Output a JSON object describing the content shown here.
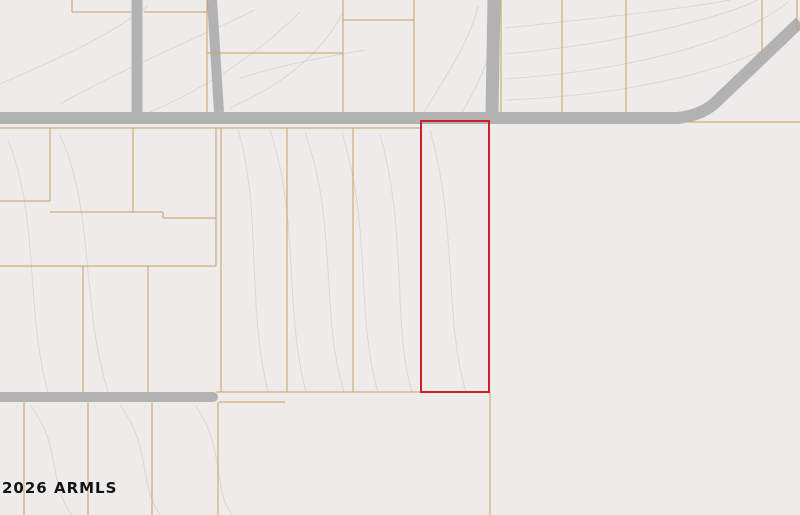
{
  "map": {
    "type": "county-plat-parcel-map",
    "copyright": "2026 ARMLS",
    "colors": {
      "background": "#edecea",
      "parcel_line": "#c7a061",
      "parcel_label": "#a0811f",
      "road": "#b2b2b2",
      "road_label": "#2f2f2f",
      "contour_line": "#d8d7d3",
      "contour_label": "#9b9b98",
      "highlight_outline": "#cb2026"
    },
    "highlight": {
      "apn": "211-21-013D",
      "outline_color": "#cb2026"
    },
    "road_labels": [
      {
        "text": "E Honda Bow Rd",
        "x": 345,
        "y": 117,
        "rot": 0
      },
      {
        "text": "E Honda Bow Rd",
        "x": 623,
        "y": 116,
        "rot": 0
      },
      {
        "text": "E Rolling Rock Dr",
        "x": 85,
        "y": 396,
        "rot": 0
      },
      {
        "text": "N 18Th Way",
        "x": 137,
        "y": 52,
        "rot": -90
      },
      {
        "text": "N 21St St",
        "x": 757,
        "y": 57,
        "rot": -40
      },
      {
        "text": "N",
        "x": 212,
        "y": 6,
        "rot": -90
      }
    ],
    "parcel_labels": [
      {
        "text": "202-20-654N",
        "x": 103,
        "y": 66
      },
      {
        "text": "202-20-654S",
        "x": 173,
        "y": 66
      },
      {
        "text": "202-20-654A",
        "x": 278,
        "y": 20
      },
      {
        "text": "202-20-654M",
        "x": 277,
        "y": 87
      },
      {
        "text": "202-20-654Q",
        "x": 380,
        "y": 70
      },
      {
        "text": "202-20-654P",
        "x": 446,
        "y": 62
      },
      {
        "text": "202-20-442D",
        "x": 531,
        "y": 53
      },
      {
        "text": "202-20-442B",
        "x": 595,
        "y": 54
      },
      {
        "text": "202-20-442F",
        "x": 687,
        "y": 46
      },
      {
        "text": "202-20-565",
        "x": 790,
        "y": 9
      },
      {
        "text": "211-21-009M",
        "x": 27,
        "y": 162
      },
      {
        "text": "211-21-009L",
        "x": 92,
        "y": 167
      },
      {
        "text": "211-21-009J",
        "x": 174,
        "y": 164
      },
      {
        "text": "211-21-009N",
        "x": 21,
        "y": 235
      },
      {
        "text": "211-21-009K",
        "x": 151,
        "y": 238
      },
      {
        "text": "211-21-009P",
        "x": 22,
        "y": 287
      },
      {
        "text": "211-21-009C",
        "x": 116,
        "y": 287
      },
      {
        "text": "211-21-009D",
        "x": 180,
        "y": 288
      },
      {
        "text": "211-21-009P",
        "x": 22,
        "y": 350
      },
      {
        "text": "211-21-009C",
        "x": 116,
        "y": 350
      },
      {
        "text": "211-21-009D",
        "x": 184,
        "y": 350
      },
      {
        "text": "211-21-013A",
        "x": 252,
        "y": 214
      },
      {
        "text": "211-21-013B",
        "x": 318,
        "y": 214
      },
      {
        "text": "211-21-013C",
        "x": 388,
        "y": 215
      },
      {
        "text": "211-21-013D",
        "x": 458,
        "y": 215
      },
      {
        "text": "211-21-013A",
        "x": 252,
        "y": 351
      },
      {
        "text": "211-21-013B",
        "x": 318,
        "y": 351
      },
      {
        "text": "211-21-013C",
        "x": 388,
        "y": 351
      },
      {
        "text": "211-21-013D",
        "x": 458,
        "y": 352
      },
      {
        "text": "211-21-030C",
        "x": -22,
        "y": 460
      },
      {
        "text": "211-21-030D",
        "x": 57,
        "y": 460
      },
      {
        "text": "211-21-010E",
        "x": 115,
        "y": 460
      },
      {
        "text": "211-21-010F",
        "x": 180,
        "y": 460
      },
      {
        "text": "211-21-005B",
        "x": 353,
        "y": 461
      }
    ],
    "contour_labels": [
      {
        "text": "2180",
        "x": 286,
        "y": 61,
        "rot": -18
      },
      {
        "text": "0",
        "x": 498,
        "y": 28,
        "rot": 0
      },
      {
        "text": "30",
        "x": 501,
        "y": 54,
        "rot": 0
      },
      {
        "text": "240",
        "x": 503,
        "y": 78,
        "rot": 0
      },
      {
        "text": "2250",
        "x": 503,
        "y": 99,
        "rot": 0
      },
      {
        "text": "2270",
        "x": 503,
        "y": 137,
        "rot": -22
      },
      {
        "text": "2280",
        "x": 503,
        "y": 152,
        "rot": -20
      },
      {
        "text": "2350",
        "x": 482,
        "y": 490,
        "rot": -10
      },
      {
        "text": "2360",
        "x": 530,
        "y": 474,
        "rot": -10
      },
      {
        "text": "2340",
        "x": 529,
        "y": 499,
        "rot": -10
      },
      {
        "text": "2330",
        "x": 605,
        "y": 486,
        "rot": -18
      },
      {
        "text": "2320",
        "x": 606,
        "y": 501,
        "rot": -12
      }
    ]
  }
}
